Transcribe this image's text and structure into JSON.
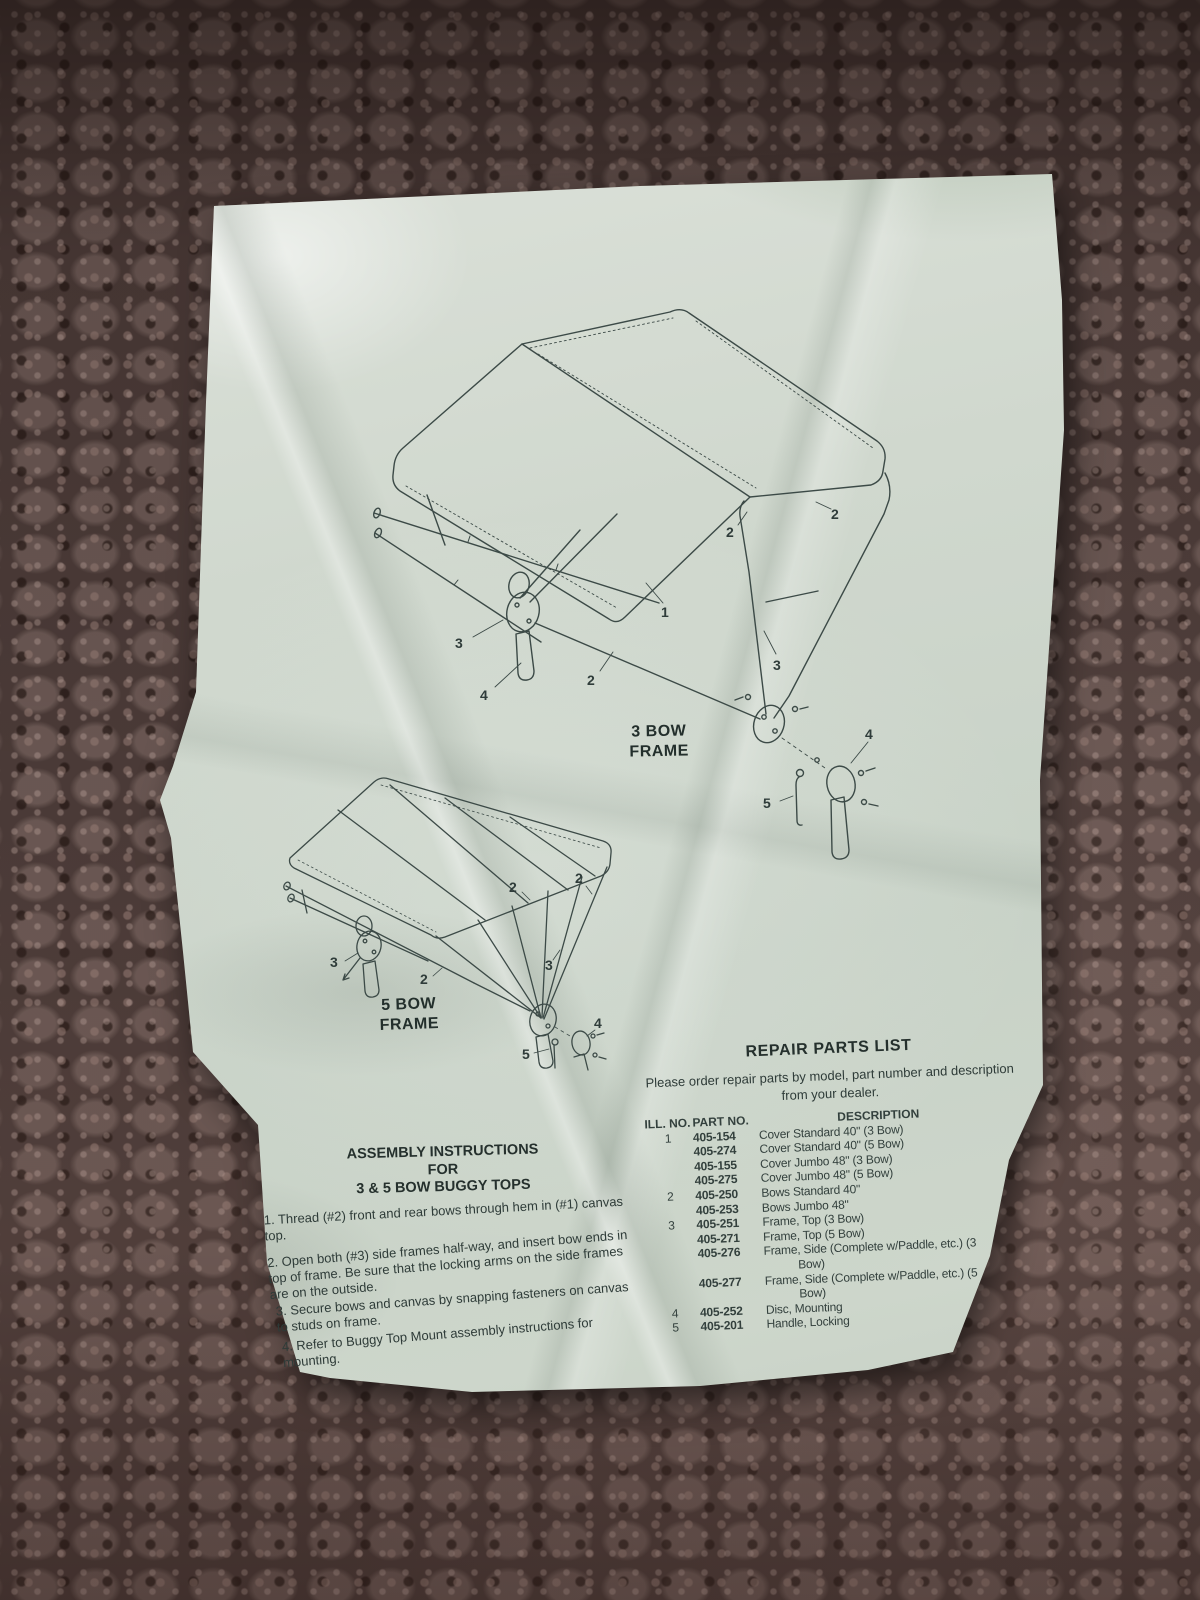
{
  "page": {
    "diagrams": {
      "three_bow": {
        "caption": [
          "3 BOW",
          "FRAME"
        ],
        "callouts": [
          "1",
          "2",
          "2",
          "2",
          "3",
          "3",
          "4",
          "4",
          "5"
        ]
      },
      "five_bow": {
        "caption": [
          "5 BOW",
          "FRAME"
        ],
        "callouts": [
          "2",
          "2",
          "2",
          "3",
          "3",
          "4",
          "5"
        ]
      }
    },
    "assembly": {
      "heading": [
        "ASSEMBLY INSTRUCTIONS",
        "FOR",
        "3 & 5 BOW BUGGY TOPS"
      ],
      "steps": [
        "1. Thread (#2) front and rear bows through hem in (#1) canvas top.",
        "2. Open both (#3) side frames half-way, and insert bow ends in top of frame. Be sure that the locking arms on the side frames are on the outside.",
        "3. Secure bows and canvas by snapping fasteners on canvas to studs on frame.",
        "4. Refer to Buggy Top Mount assembly instructions for mounting."
      ]
    },
    "parts": {
      "heading": "REPAIR PARTS LIST",
      "intro": "Please order repair parts by model, part number and description from your dealer.",
      "columns": {
        "ill": "ILL. NO.",
        "part": "PART NO.",
        "desc": "DESCRIPTION"
      },
      "rows": [
        {
          "ill": "1",
          "part": "405-154",
          "desc": "Cover Standard 40\" (3 Bow)"
        },
        {
          "ill": "",
          "part": "405-274",
          "desc": "Cover Standard 40\" (5 Bow)"
        },
        {
          "ill": "",
          "part": "405-155",
          "desc": "Cover Jumbo 48\" (3 Bow)"
        },
        {
          "ill": "",
          "part": "405-275",
          "desc": "Cover Jumbo 48\" (5 Bow)"
        },
        {
          "ill": "2",
          "part": "405-250",
          "desc": "Bows Standard 40\""
        },
        {
          "ill": "",
          "part": "405-253",
          "desc": "Bows Jumbo 48\""
        },
        {
          "ill": "3",
          "part": "405-251",
          "desc": "Frame, Top (3 Bow)"
        },
        {
          "ill": "",
          "part": "405-271",
          "desc": "Frame, Top (5 Bow)"
        },
        {
          "ill": "",
          "part": "405-276",
          "desc": "Frame, Side (Complete w/Paddle, etc.) (3 Bow)"
        },
        {
          "ill": "",
          "part": "405-277",
          "desc": "Frame, Side (Complete w/Paddle, etc.) (5 Bow)"
        },
        {
          "ill": "4",
          "part": "405-252",
          "desc": "Disc, Mounting"
        },
        {
          "ill": "5",
          "part": "405-201",
          "desc": "Handle, Locking"
        }
      ]
    }
  }
}
